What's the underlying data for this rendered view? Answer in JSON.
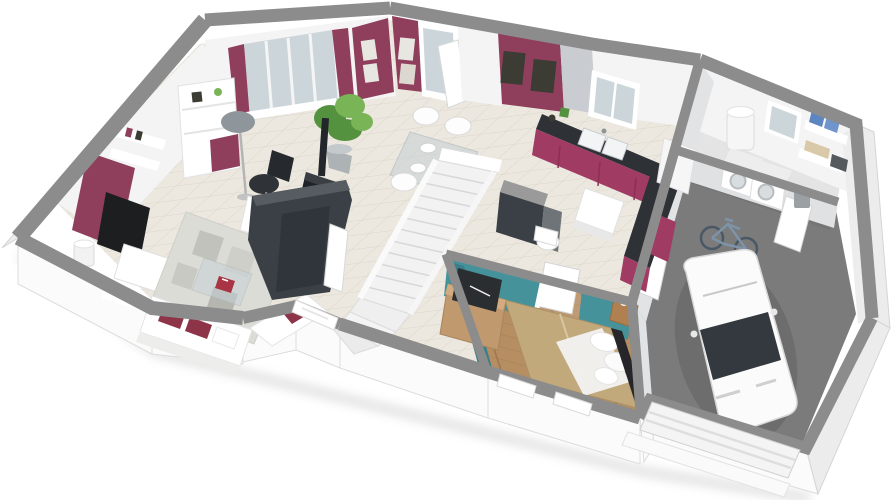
{
  "meta": {
    "kind": "3d-isometric-floor-plan-render",
    "storey": "ground-floor",
    "background": "#ffffff"
  },
  "palette": {
    "wallTop": "#8c8c8c",
    "wallWhite": "#fbfbfb",
    "wallShade": "#ececec",
    "interiorWhite": "#f4f4f5",
    "burgundy": "#8f3f5c",
    "kitchenBurgundy": "#a03b63",
    "teal": "#46929b",
    "tealDark": "#3a7e88",
    "tile": "#ece8df",
    "tileLine": "#d9d4c7",
    "wood": "#b68e62",
    "woodLine": "#9d7850",
    "concrete": "#7b7b7b",
    "charcoal": "#3a4045",
    "counterDark": "#2e3236",
    "stoveBlack": "#22262a",
    "bedTan": "#c2a97c",
    "glass": "#ccd6da",
    "glassDark": "#323940",
    "plantGreen": "#55923f",
    "plantGreenLight": "#79b457",
    "rug": "#dcdcd6",
    "rugDark": "#b9b9b4",
    "accentRed": "#a93544",
    "bikeBlue": "#7d93a8",
    "steel": "#9aa0a3",
    "artDark": "#3c3c34",
    "grayPanel": "#c9ccd0"
  },
  "scene": {
    "rooms": [
      {
        "name": "living-room",
        "floor_finish": "beige-tile",
        "accent_wall": "burgundy",
        "furniture": [
          "corner-sofa",
          "red-cushions",
          "patchwork-rug",
          "glass-coffee-table",
          "tv-on-burgundy-panel",
          "tv-stand",
          "bookcase",
          "wall-shelves",
          "floor-lamp",
          "side-lamp",
          "desk",
          "office-chair",
          "bay-window"
        ]
      },
      {
        "name": "dining-area",
        "floor_finish": "beige-tile",
        "furniture": [
          "glass-dining-table",
          "white-chairs",
          "plates",
          "potted-plant",
          "wood-stove",
          "french-door",
          "picture-frames"
        ]
      },
      {
        "name": "entry",
        "furniture": [
          "front-door",
          "charcoal-closet"
        ]
      },
      {
        "name": "staircase",
        "furniture": [
          "straight-run",
          "winder-steps",
          "white-railing"
        ]
      },
      {
        "name": "wc",
        "furniture": [
          "toilet",
          "charcoal-partition"
        ]
      },
      {
        "name": "kitchen",
        "cabinet_color": "burgundy",
        "furniture": [
          "l-shaped-counter",
          "dark-worktop",
          "double-sink",
          "window-over-sink",
          "white-island-unit",
          "tall-white-cabinet"
        ]
      },
      {
        "name": "bedroom",
        "floor_finish": "wood-planks",
        "accent_wall": "teal",
        "furniture": [
          "double-bed",
          "white-pillows",
          "dark-headboard",
          "dresser-with-tv",
          "nightstand",
          "open-door",
          "south-windows"
        ]
      },
      {
        "name": "utility-room",
        "floor_finish": "gray-tile",
        "furniture": [
          "water-heater",
          "washing-machine",
          "dryer",
          "wall-shelves",
          "blue-storage-boxes",
          "window",
          "door-to-garage",
          "waste-bin"
        ]
      },
      {
        "name": "garage",
        "floor_finish": "concrete",
        "furniture": [
          "white-car",
          "bicycle",
          "sectional-garage-door",
          "entrance-apron"
        ]
      }
    ]
  }
}
